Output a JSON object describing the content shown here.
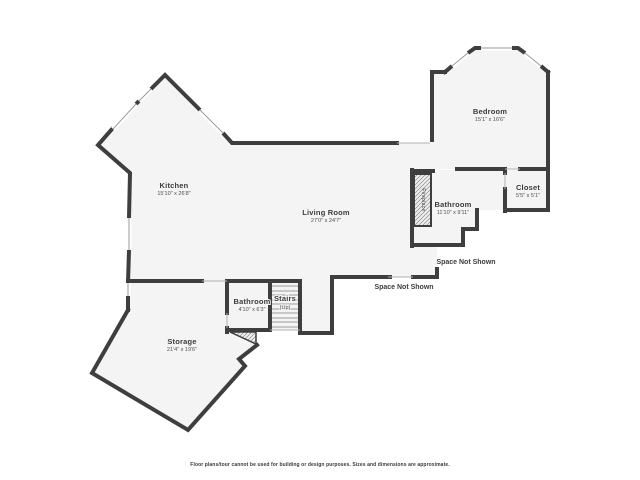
{
  "plan": {
    "rooms": [
      {
        "id": "kitchen",
        "name": "Kitchen",
        "dims": "15'10\" x 26'8\""
      },
      {
        "id": "living-room",
        "name": "Living Room",
        "dims": "27'0\" x 24'7\""
      },
      {
        "id": "bedroom",
        "name": "Bedroom",
        "dims": "15'1\" x 16'6\""
      },
      {
        "id": "bathroom-main",
        "name": "Bathroom",
        "dims": "11'10\" x 9'11\""
      },
      {
        "id": "closet",
        "name": "Closet",
        "dims": "5'5\" x 5'1\""
      },
      {
        "id": "bathroom-lower",
        "name": "Bathroom",
        "dims": "4'10\" x 6'3\""
      },
      {
        "id": "stairs",
        "name": "Stairs",
        "dims": "(Up)"
      },
      {
        "id": "storage",
        "name": "Storage",
        "dims": "21'4\" x 19'6\""
      }
    ],
    "fireplace_label": "Fireplace",
    "space_not_shown_1": "Space Not Shown",
    "space_not_shown_2": "Space Not Shown",
    "disclaimer": "Floor plans/tour cannot be used for building or design purposes. Sizes and dimensions are approximate.",
    "colors": {
      "wall": "#3e3e3e",
      "floor": "#f4f4f4",
      "window_line": "#9a9a9a",
      "hatch": "#8a8a8a",
      "label": "#3c3c3c",
      "dims": "#4f4f4f"
    }
  }
}
